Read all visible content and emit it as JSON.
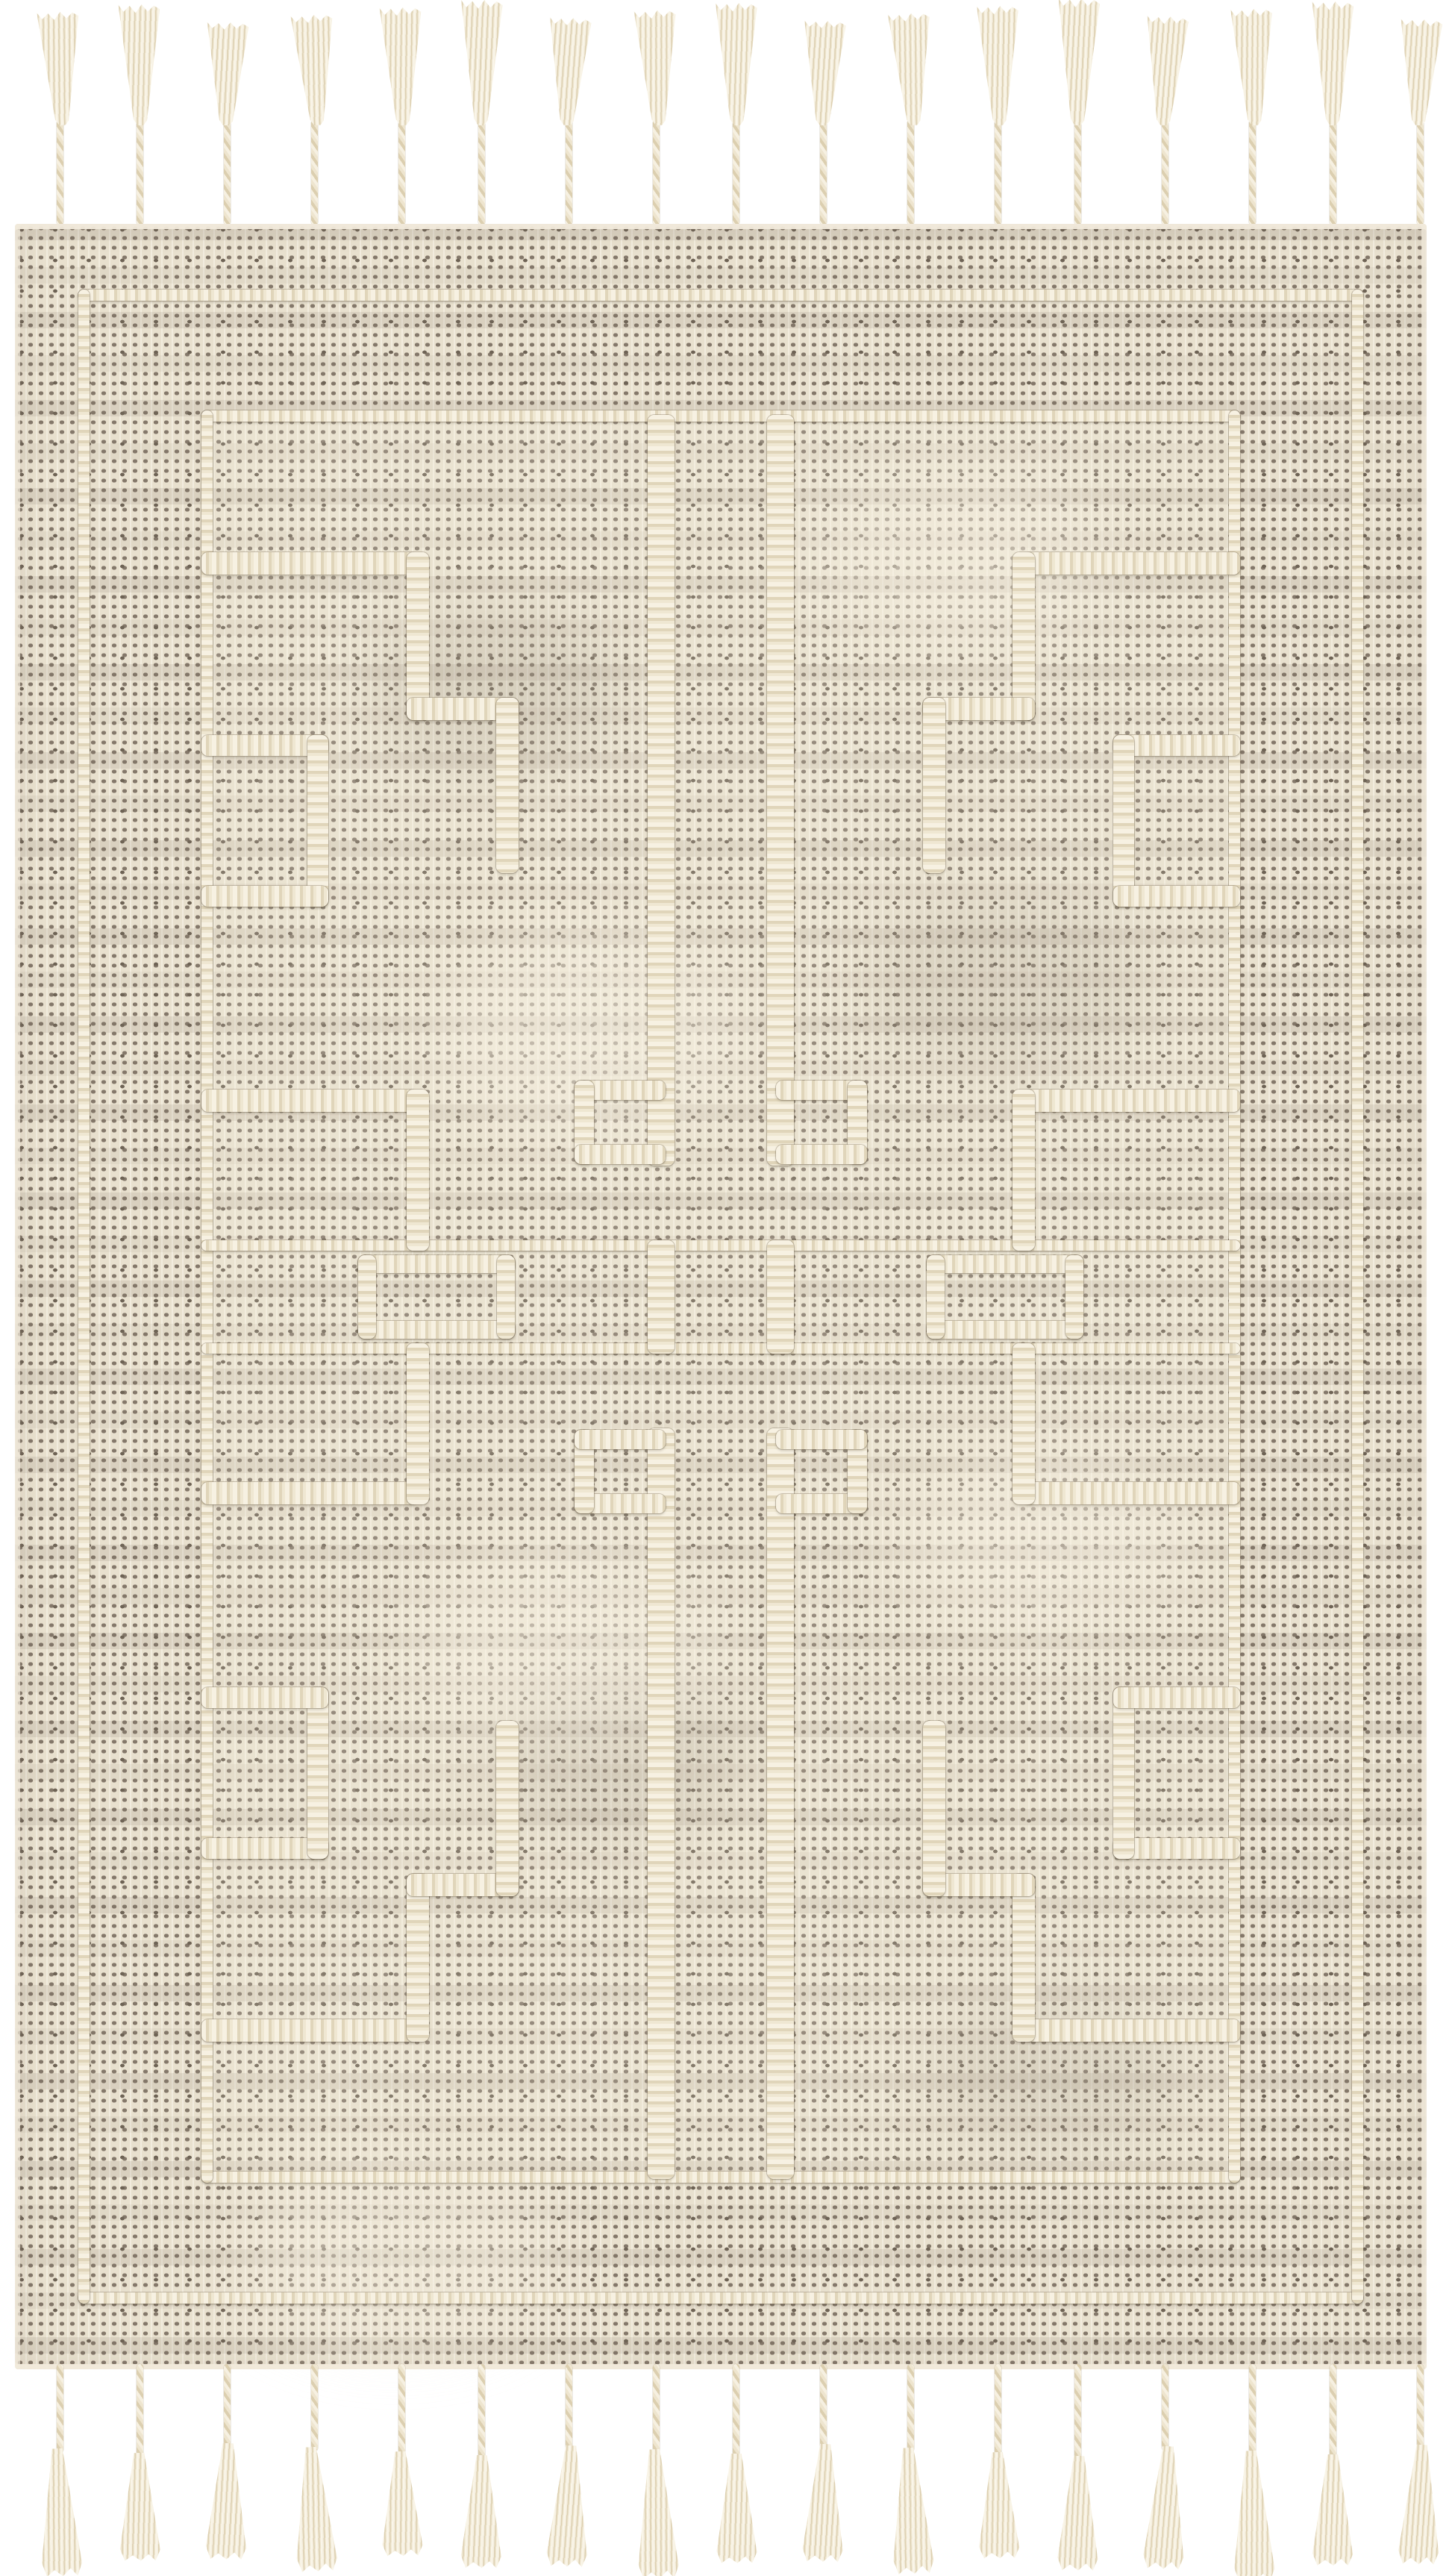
{
  "scene": {
    "subject": "Handwoven flat-weave area rug photographed flat on a white background",
    "alt": "Cream and taupe handwoven rug with raised braided Greek-key labyrinth motifs, double braided border rectangles, a braided center band, and braided fringe tassels along the top and bottom edges",
    "orientation": "vertical rectangle"
  },
  "palette": {
    "page-bg": "#ffffff",
    "weave-base": "#e8e0ce",
    "weave-dot": "#84786a",
    "weave-dot-dark": "#6e6355",
    "braid-light": "#f7f1e2",
    "braid-mid": "#efe7d2",
    "braid-shade": "#e0d5ba",
    "fringe-light": "#f6f0e1",
    "fringe-mid": "#eee5cf",
    "fringe-shade": "#dccfb0"
  },
  "fringe": {
    "top_count": 17,
    "bottom_count": 17,
    "style": "braided cord ending in a loose twisted tuft"
  },
  "rug": {
    "texture": "fine taupe dot-grid weave on cream ground",
    "borders": {
      "outer": "thin braided cream rectangle near rug edge",
      "inner": "thin braided cream rectangle framing the field"
    },
    "field_motif": "four mirrored Greek-key / labyrinth motifs with stepped arms, tooth rectangles on the frame, and long central bars with hooked feet",
    "center_band": "two thin braided lines with small braided rectangles and two short central bars"
  }
}
